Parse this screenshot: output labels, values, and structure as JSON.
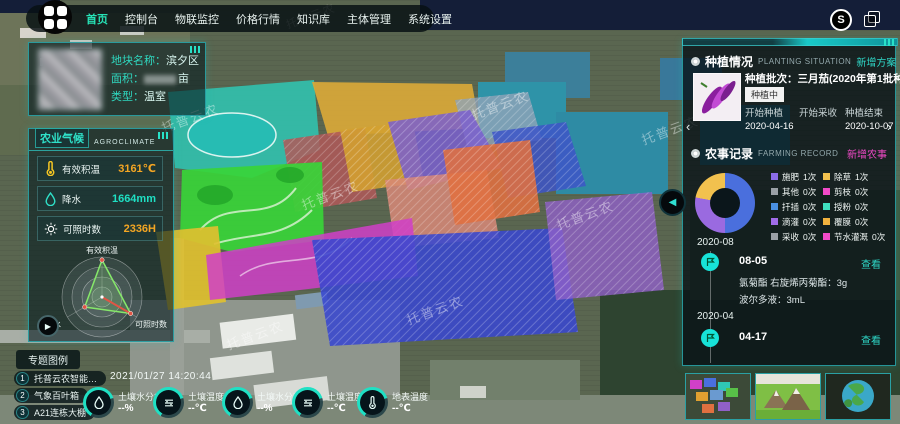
{
  "app": {
    "watermark": "托普云农"
  },
  "colors": {
    "accent": "#1fe0c4",
    "orange": "#f5a623",
    "magenta": "#f24ac8"
  },
  "icons": {
    "prev": "‹",
    "next": "›",
    "collapse": "◀",
    "play": "▶",
    "sync": "S"
  },
  "nav": {
    "items": [
      "首页",
      "控制台",
      "物联监控",
      "价格行情",
      "知识库",
      "主体管理",
      "系统设置"
    ],
    "active": "首页"
  },
  "plot_info": {
    "name_label": "地块名称：",
    "name_value": "滨夕区",
    "area_label": "面积：",
    "area_unit": "亩",
    "type_label": "类型：",
    "type_value": "温室"
  },
  "agroclimate": {
    "title": "农业气候",
    "subtitle": "AGROCLIMATE",
    "stats": [
      {
        "label": "有效积温",
        "value": "3161℃",
        "color": "#f5a623"
      },
      {
        "label": "降水",
        "value": "1664mm",
        "color": "#1fe0c4"
      },
      {
        "label": "可照时数",
        "value": "2336H",
        "color": "#f5a623"
      }
    ]
  },
  "radar_labels": {
    "top": "有效积温",
    "left": "降水",
    "right": "可照时数"
  },
  "legend_toggle": "专题图例",
  "layers": [
    {
      "num": "1",
      "label": "托普云农智能…"
    },
    {
      "num": "2",
      "label": "气象百叶箱"
    },
    {
      "num": "3",
      "label": "A21连栋大棚"
    }
  ],
  "datetime": "2021/01/27 14:20:44",
  "sensors": [
    {
      "label": "土壤水分30",
      "value": "--%"
    },
    {
      "label": "土壤温度50",
      "value": "--℃"
    },
    {
      "label": "土壤水分70",
      "value": "--%"
    },
    {
      "label": "土壤温度10",
      "value": "--℃"
    },
    {
      "label": "地表温度",
      "value": "--℃"
    }
  ],
  "planting": {
    "title": "种植情况",
    "subtitle": "PLANTING SITUATION",
    "action": "新增方案",
    "batch_line": "种植批次：三月茄(2020年第1批种植)",
    "status": "种植中",
    "fields": [
      {
        "label": "开始种植",
        "value": "2020-04-16"
      },
      {
        "label": "开始采收",
        "value": ""
      },
      {
        "label": "种植结束",
        "value": "2020-10-07"
      }
    ]
  },
  "farming": {
    "title": "农事记录",
    "subtitle": "FARMING RECORD",
    "action": "新增农事",
    "legend_col1": [
      {
        "label": "施肥",
        "count": "1次",
        "color": "#8b6ce8"
      },
      {
        "label": "其他",
        "count": "0次",
        "color": "#9aa0a6"
      },
      {
        "label": "扦插",
        "count": "0次",
        "color": "#4a90e2"
      },
      {
        "label": "滴灌",
        "count": "0次",
        "color": "#a06ce8"
      },
      {
        "label": "采收",
        "count": "0次",
        "color": "#9aa0a6"
      }
    ],
    "legend_col2": [
      {
        "label": "除草",
        "count": "1次",
        "color": "#f2c14e"
      },
      {
        "label": "剪枝",
        "count": "0次",
        "color": "#f24ac8"
      },
      {
        "label": "授粉",
        "count": "0次",
        "color": "#3fe0c0"
      },
      {
        "label": "覆膜",
        "count": "0次",
        "color": "#f2b23e"
      },
      {
        "label": "节水灌溉",
        "count": "0次",
        "color": "#f24ac8"
      }
    ],
    "timeline": [
      {
        "month": "2020-08",
        "date": "08-05",
        "view": "查看",
        "lines": [
          "氯菊酯 右旋烯丙菊酯：3g",
          "波尔多液：3mL"
        ]
      },
      {
        "month": "2020-04",
        "date": "04-17",
        "view": "查看",
        "lines": []
      }
    ]
  },
  "chart_data": [
    {
      "type": "radar",
      "title": "农业气候",
      "axes": [
        "有效积温",
        "降水",
        "可照时数"
      ],
      "values_normalized": [
        0.9,
        0.5,
        0.8
      ],
      "max": 1,
      "grid": "circular"
    },
    {
      "type": "donut",
      "title": "农事记录",
      "slices": [
        {
          "label": "segment-blue",
          "color": "#4a6fdd",
          "percent": 50
        },
        {
          "label": "segment-purple",
          "color": "#9a6ae0",
          "percent": 28
        },
        {
          "label": "segment-yellow",
          "color": "#f2c14e",
          "percent": 22
        }
      ],
      "legend_position": "right"
    }
  ]
}
